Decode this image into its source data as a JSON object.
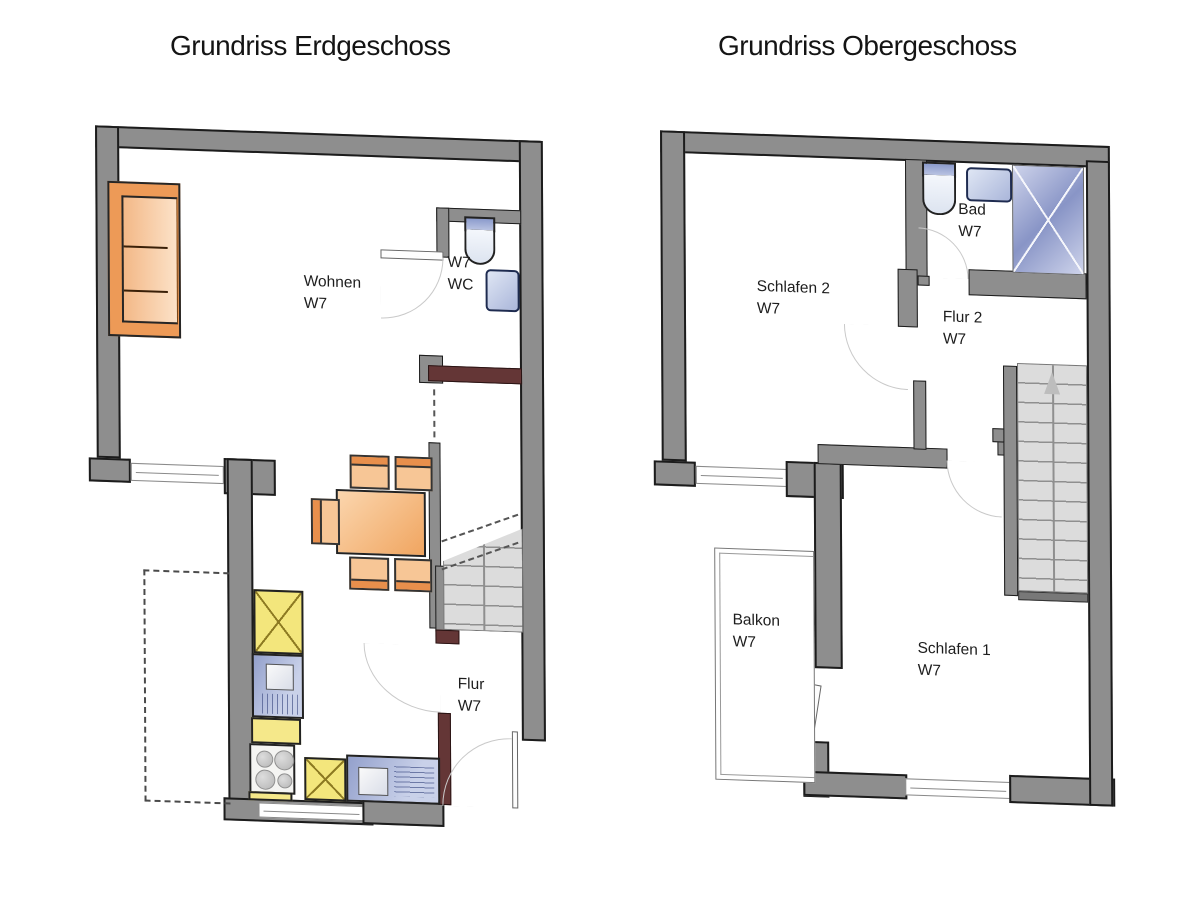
{
  "titles": {
    "left": "Grundriss Erdgeschoss",
    "right": "Grundriss Obergeschoss"
  },
  "floor1": {
    "rooms": {
      "wohnen": {
        "name": "Wohnen",
        "unit": "W7"
      },
      "wc": {
        "line1": "W7",
        "line2": "WC"
      },
      "flur": {
        "name": "Flur",
        "unit": "W7"
      }
    }
  },
  "floor2": {
    "rooms": {
      "schlafen2": {
        "name": "Schlafen 2",
        "unit": "W7"
      },
      "flur2": {
        "name": "Flur 2",
        "unit": "W7"
      },
      "bad": {
        "name": "Bad",
        "unit": "W7"
      },
      "balkon": {
        "name": "Balkon",
        "unit": "W7"
      },
      "schlafen1": {
        "name": "Schlafen 1",
        "unit": "W7"
      }
    }
  },
  "palette": {
    "wall_gray": "#8e8e8e",
    "wall_outline": "#1c1c1c",
    "accent_wall_maroon": "#643636",
    "furniture_orange": "#ed9a57",
    "kitchen_yellow": "#f3e67c",
    "fixture_blue": "#aab6da",
    "stair_gray": "#dcdcdc",
    "door_arc_gray": "#c9c9c9"
  }
}
